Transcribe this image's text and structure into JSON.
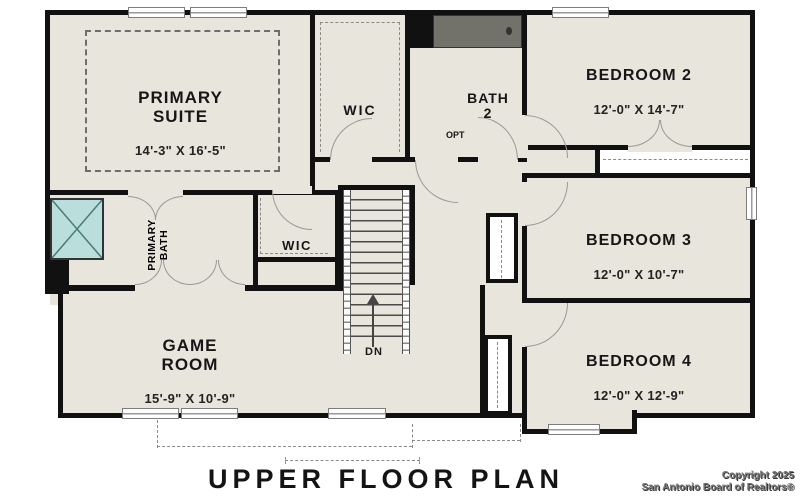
{
  "plan_title": "UPPER FLOOR PLAN",
  "copyright": {
    "line1": "Copyright 2025",
    "line2": "San Antonio Board of Realtors®"
  },
  "rooms": {
    "primary_suite": {
      "name": "PRIMARY\nSUITE",
      "dims": "14'-3\" X 16'-5\""
    },
    "wic_primary": {
      "name": "WIC"
    },
    "bath_2": {
      "name": "BATH\n2",
      "opt": "OPT"
    },
    "bedroom_2": {
      "name": "BEDROOM 2",
      "dims": "12'-0\" X 14'-7\""
    },
    "bedroom_3": {
      "name": "BEDROOM 3",
      "dims": "12'-0\" X 10'-7\""
    },
    "bedroom_4": {
      "name": "BEDROOM 4",
      "dims": "12'-0\" X 12'-9\""
    },
    "primary_bath": {
      "name": "PRIMARY\nBATH"
    },
    "wic_hall": {
      "name": "WIC"
    },
    "game_room": {
      "name": "GAME\nROOM",
      "dims": "15'-9\" X 10'-9\""
    },
    "stairs": {
      "label": "DN"
    }
  },
  "colors": {
    "wall": "#111111",
    "floor": "#e8e5dc",
    "fixture": "#b9dedc",
    "cabinet": "#8f8566",
    "page": "#ffffff"
  }
}
